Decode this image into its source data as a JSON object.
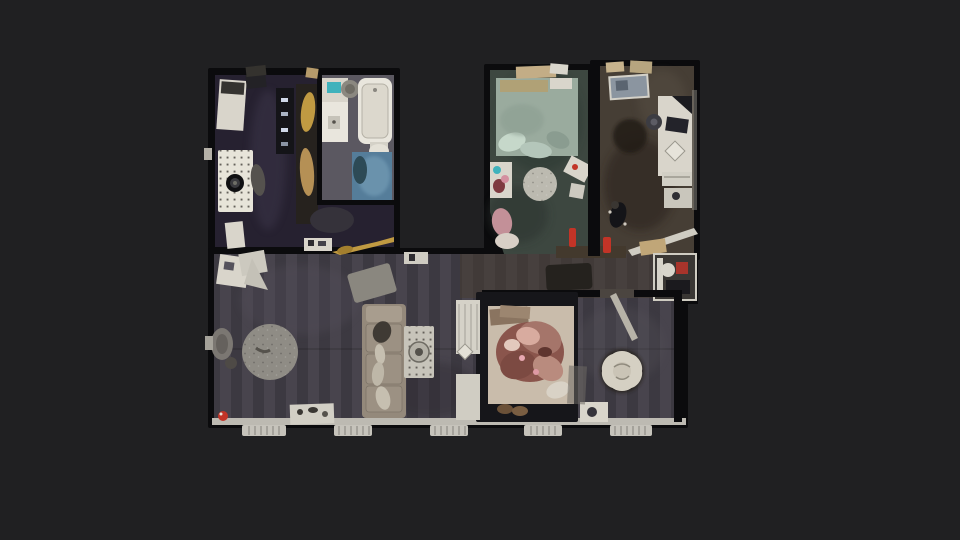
{
  "app": {
    "name": "3d-home-tour-viewer",
    "view_mode": "top-down-floorplan"
  },
  "scene": {
    "description": "photogrammetry dollhouse floor plan of an apartment on a dark canvas",
    "rooms": [
      {
        "name": "kitchen"
      },
      {
        "name": "bathroom"
      },
      {
        "name": "bedroom"
      },
      {
        "name": "office"
      },
      {
        "name": "living-room"
      },
      {
        "name": "master-bedroom"
      },
      {
        "name": "hallway"
      }
    ]
  },
  "palette": {
    "background": "#202022",
    "wall-dark": "#0b0b0d",
    "wall-light": "#bdbab2",
    "floor-kitchen": "#262130",
    "floor-bathroom": "#5b5861",
    "floor-bedroom": "#3d4740",
    "floor-office": "#463e35",
    "floor-living": "#413d46",
    "shower-blue": "#557d9a",
    "tub-white": "#e9e6dd",
    "furniture-white": "#d9d5cb",
    "rug-white": "#e7e4d9",
    "rug-gray": "#8f8c85",
    "rug-speckled": "#bcbab0",
    "mat-dotted": "#c7c4ba",
    "sofa-beige": "#94897b",
    "bed-duvet": "#9aab9e",
    "bed2-mattress": "#c9bcab",
    "blanket-rose": "#8a554c",
    "flower-rug": "#d5d0c3",
    "radiator": "#c6c3bb",
    "accent-red": "#c23427",
    "accent-teal": "#3fb2bc",
    "accent-gold": "#c09a42"
  }
}
